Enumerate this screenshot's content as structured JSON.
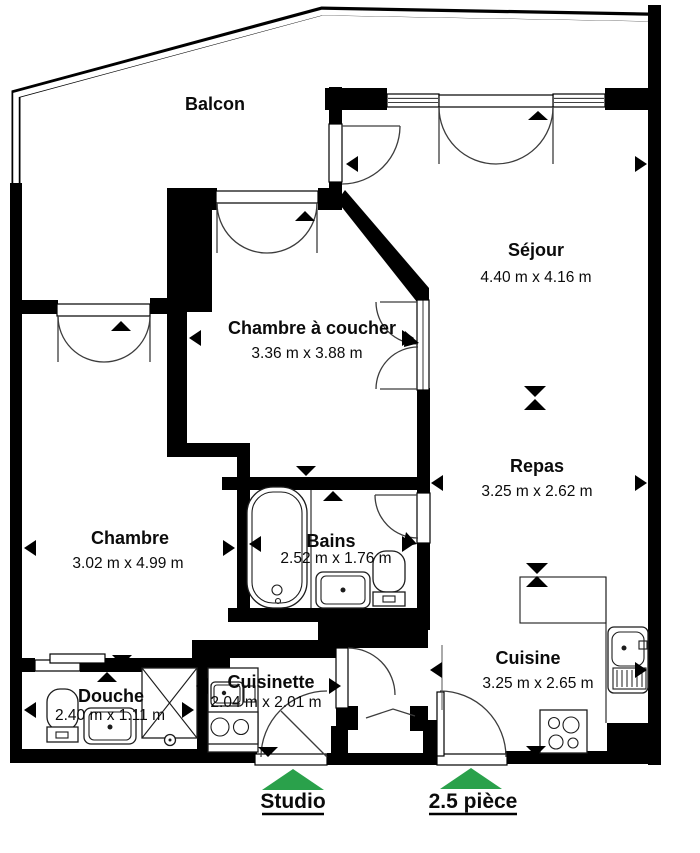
{
  "plan": {
    "rooms": {
      "balcon": {
        "label": "Balcon"
      },
      "sejour": {
        "label": "Séjour",
        "dims": "4.40 m x 4.16 m"
      },
      "chambre_a_coucher": {
        "label": "Chambre à coucher",
        "dims": "3.36 m x 3.88 m"
      },
      "chambre": {
        "label": "Chambre",
        "dims": "3.02 m x 4.99 m"
      },
      "repas": {
        "label": "Repas",
        "dims": "3.25 m x 2.62 m"
      },
      "bains": {
        "label": "Bains",
        "dims": "2.52 m x 1.76 m"
      },
      "cuisine": {
        "label": "Cuisine",
        "dims": "3.25 m x 2.65 m"
      },
      "douche": {
        "label": "Douche",
        "dims": "2.40 m x 1.11 m"
      },
      "cuisinette": {
        "label": "Cuisinette",
        "dims": "2.04 m x 2.01 m"
      }
    },
    "entrances": {
      "studio": {
        "label": "Studio"
      },
      "deux_cinq_piece": {
        "label": "2.5 pièce"
      }
    },
    "colors": {
      "arrow_green": "#2aa14b",
      "wall": "#000000",
      "background": "#ffffff"
    }
  }
}
